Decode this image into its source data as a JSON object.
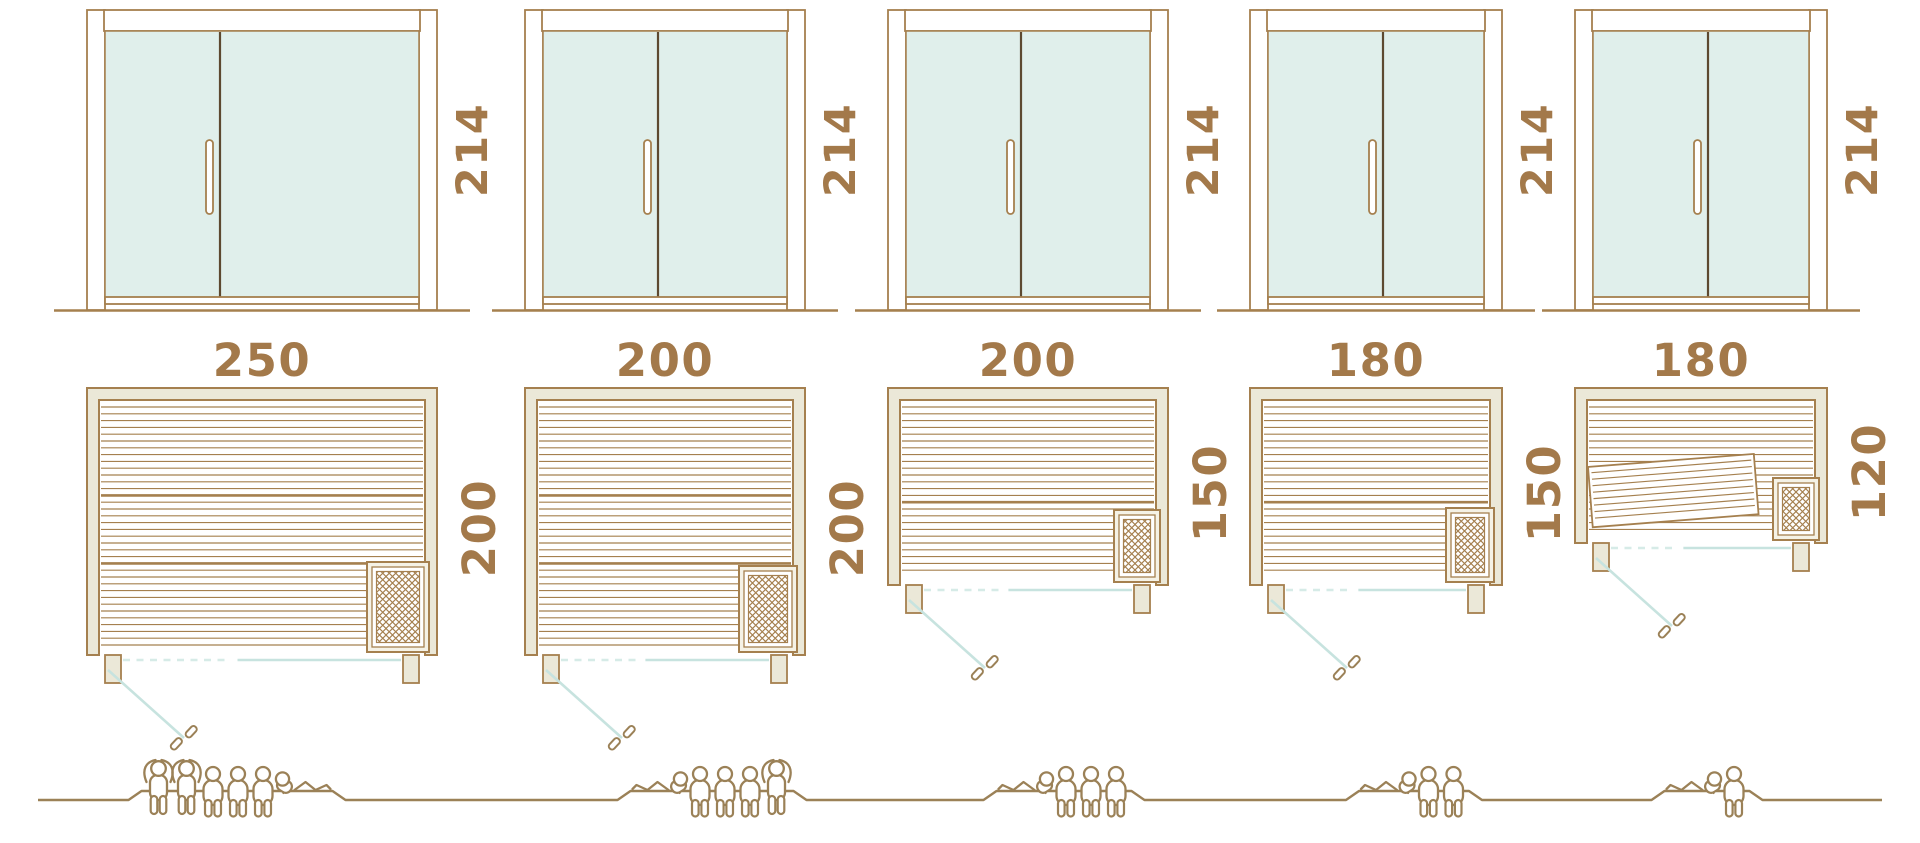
{
  "palette": {
    "outline_brown": "#a5804f",
    "dark_brown": "#5d4930",
    "dimension_text": "#a3794a",
    "wall_cream": "#ebe8d8",
    "glass_mint": "#e0efeb",
    "swing_teal": "#c7e3df",
    "swing_teal_dashed": "#d6ebe7",
    "figure_brown": "#9b8157",
    "heater_cream": "#f5f2e6",
    "white": "#ffffff"
  },
  "units": [
    {
      "name": "sauna-250x200",
      "door": {
        "height_label": "214",
        "height_cm": 214
      },
      "plan": {
        "width_label": "250",
        "depth_label": "200",
        "width_cm": 250,
        "depth_cm": 200,
        "heater": true,
        "tilted_bench": false
      },
      "capacity": {
        "people": 6,
        "figures": [
          "standing",
          "standing",
          "sitting",
          "sitting",
          "sitting",
          "lying-right"
        ]
      }
    },
    {
      "name": "sauna-200x200",
      "door": {
        "height_label": "214",
        "height_cm": 214
      },
      "plan": {
        "width_label": "200",
        "depth_label": "200",
        "width_cm": 200,
        "depth_cm": 200,
        "heater": true,
        "tilted_bench": false
      },
      "capacity": {
        "people": 5,
        "figures": [
          "lying-left",
          "sitting",
          "sitting",
          "sitting",
          "standing"
        ]
      }
    },
    {
      "name": "sauna-200x150",
      "door": {
        "height_label": "214",
        "height_cm": 214
      },
      "plan": {
        "width_label": "200",
        "depth_label": "150",
        "width_cm": 200,
        "depth_cm": 150,
        "heater": true,
        "tilted_bench": false
      },
      "capacity": {
        "people": 4,
        "figures": [
          "lying-left",
          "sitting",
          "sitting",
          "sitting"
        ]
      }
    },
    {
      "name": "sauna-180x150",
      "door": {
        "height_label": "214",
        "height_cm": 214
      },
      "plan": {
        "width_label": "180",
        "depth_label": "150",
        "width_cm": 180,
        "depth_cm": 150,
        "heater": true,
        "tilted_bench": false
      },
      "capacity": {
        "people": 3,
        "figures": [
          "lying-left",
          "sitting",
          "sitting"
        ]
      }
    },
    {
      "name": "sauna-180x120",
      "door": {
        "height_label": "214",
        "height_cm": 214
      },
      "plan": {
        "width_label": "180",
        "depth_label": "120",
        "width_cm": 180,
        "depth_cm": 120,
        "heater": true,
        "tilted_bench": true
      },
      "capacity": {
        "people": 2,
        "figures": [
          "lying-left",
          "sitting"
        ]
      }
    }
  ]
}
